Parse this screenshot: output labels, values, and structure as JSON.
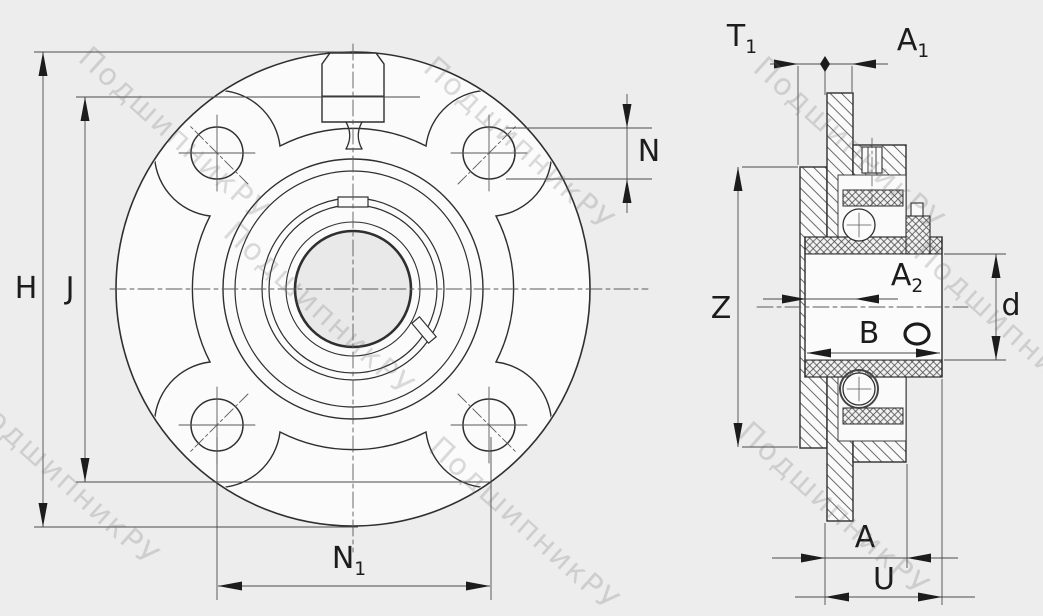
{
  "drawing": {
    "watermark_text": "ПодшипникРУ"
  },
  "dims": {
    "H": {
      "main": "H",
      "sub": ""
    },
    "J": {
      "main": "J",
      "sub": ""
    },
    "N": {
      "main": "N",
      "sub": ""
    },
    "N1": {
      "main": "N",
      "sub": "1"
    },
    "T1": {
      "main": "T",
      "sub": "1"
    },
    "A1": {
      "main": "A",
      "sub": "1"
    },
    "Z": {
      "main": "Z",
      "sub": ""
    },
    "A2": {
      "main": "A",
      "sub": "2"
    },
    "B": {
      "main": "B",
      "sub": ""
    },
    "d": {
      "main": "d",
      "sub": ""
    },
    "A": {
      "main": "A",
      "sub": ""
    },
    "U": {
      "main": "U",
      "sub": ""
    }
  }
}
